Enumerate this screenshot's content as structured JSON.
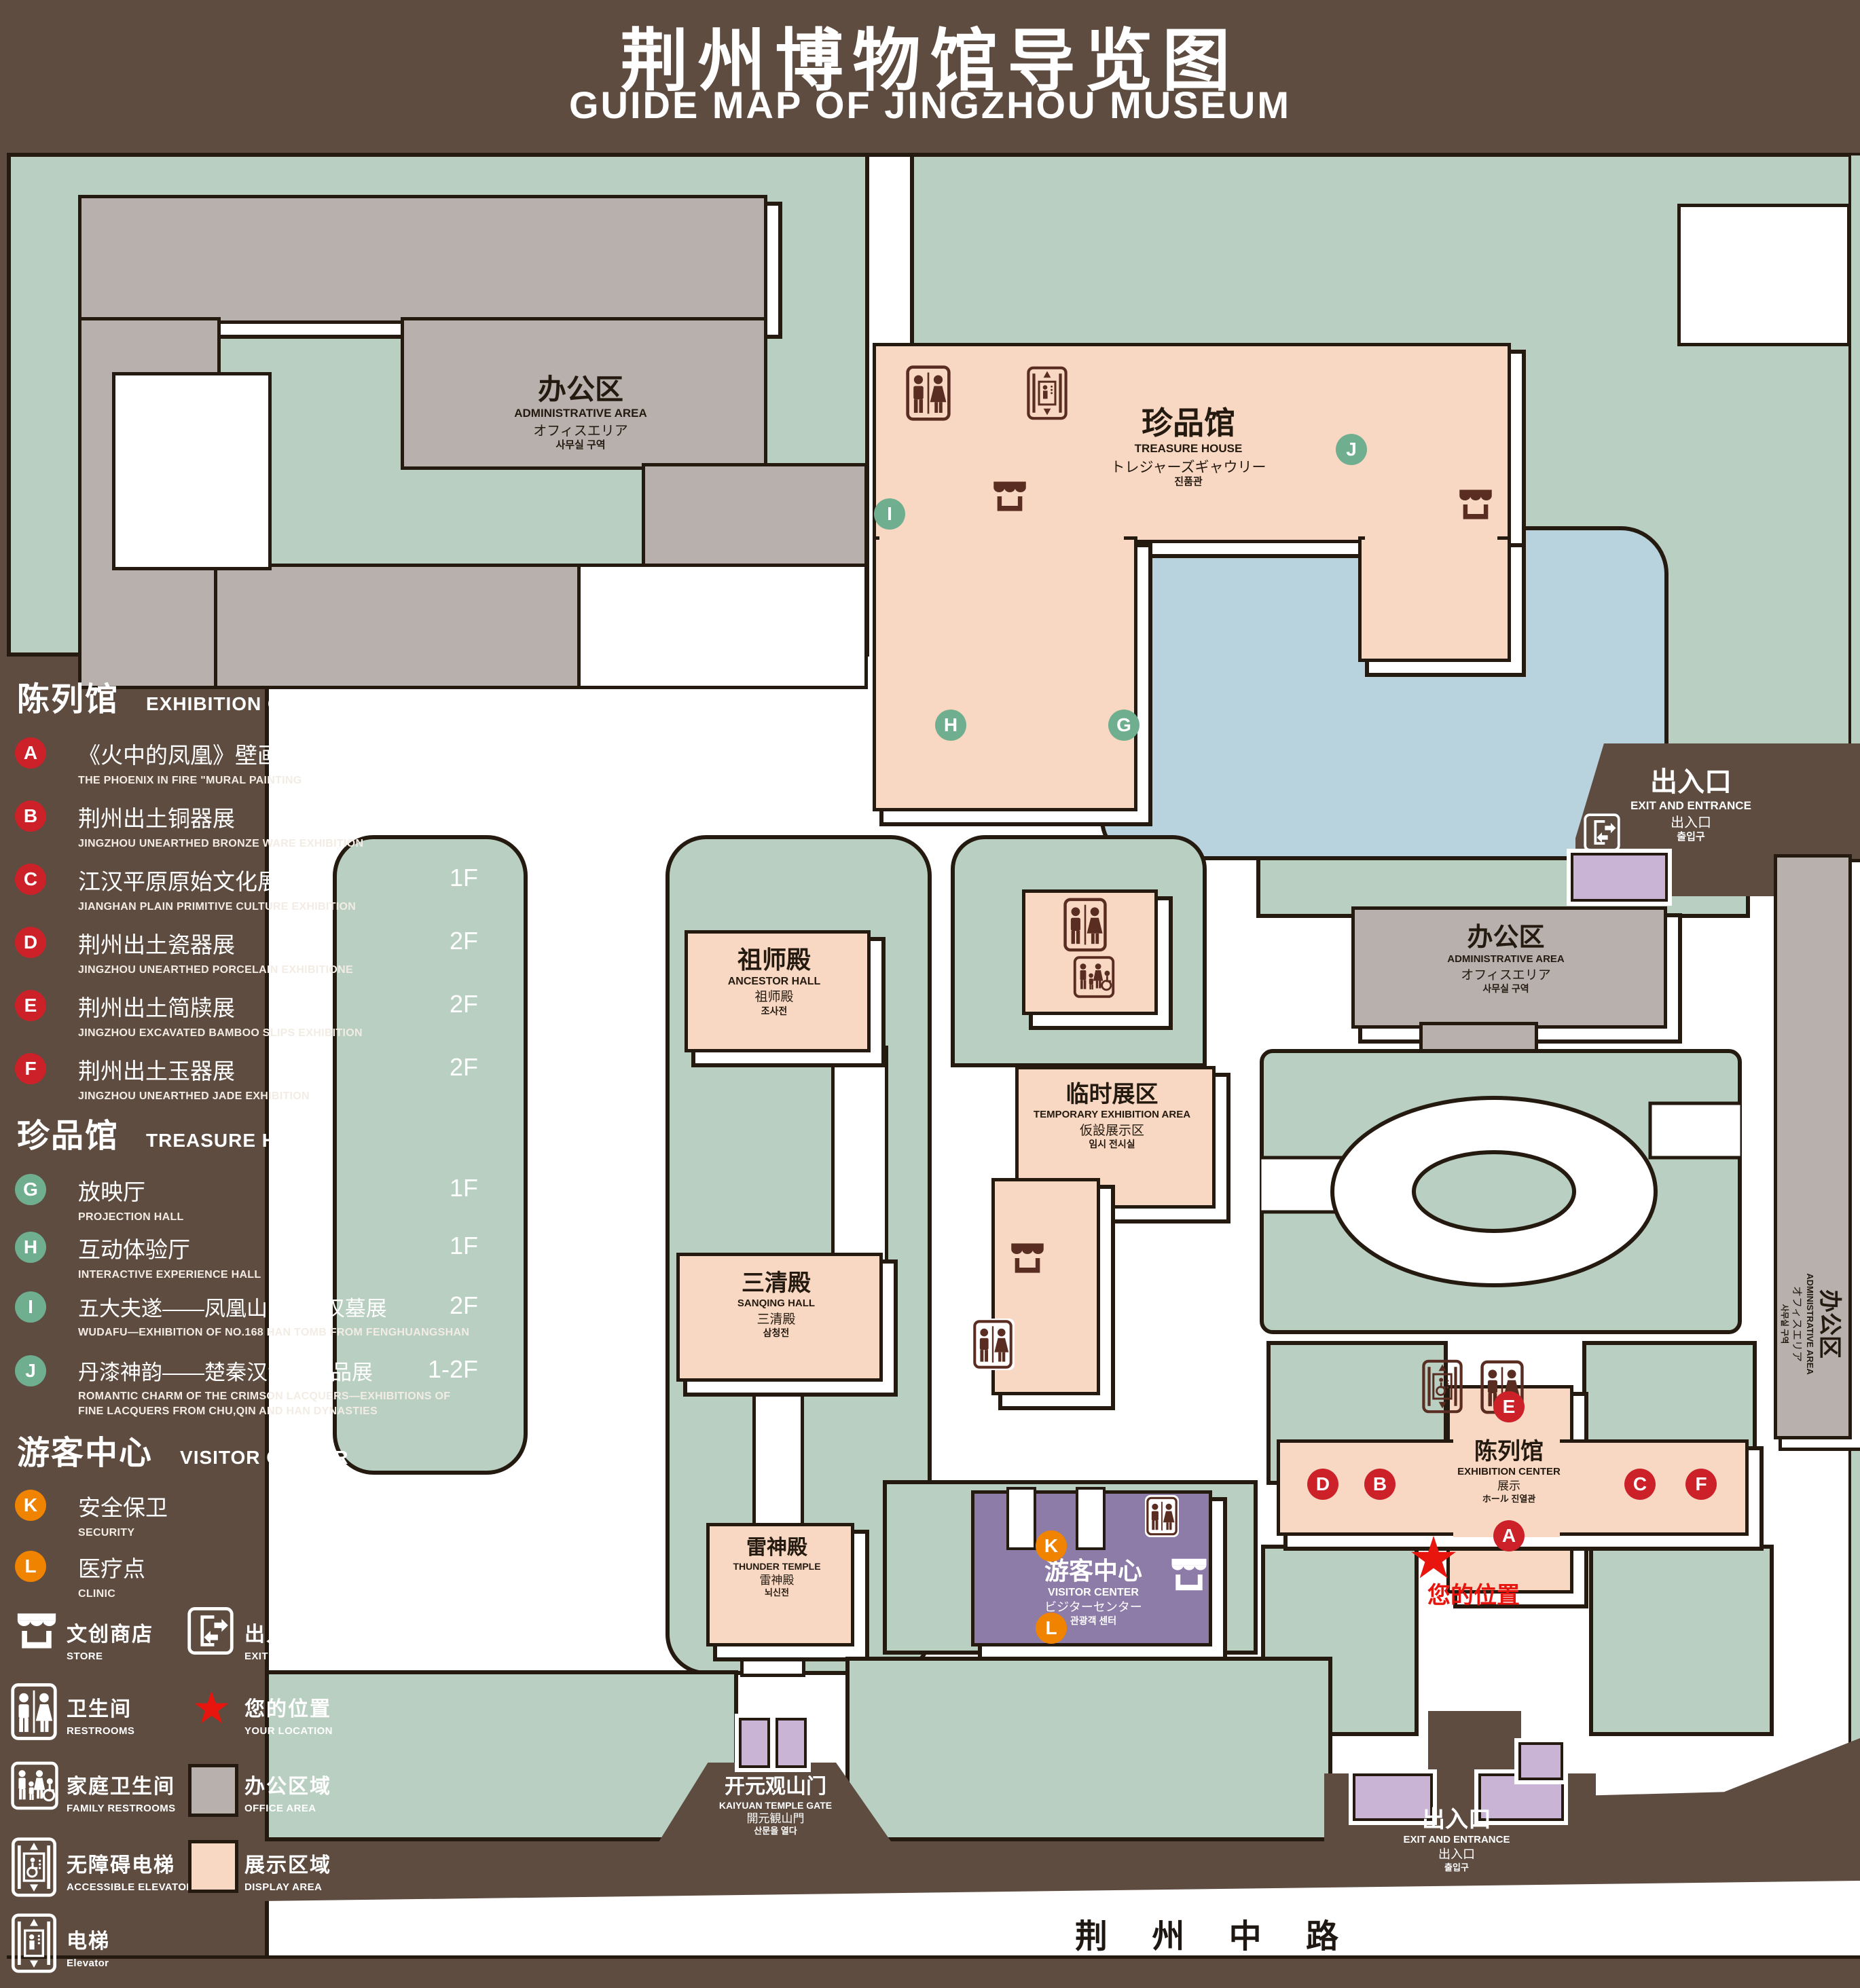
{
  "title": {
    "zh": "荆州博物馆导览图",
    "en": "GUIDE MAP OF JINGZHOU MUSEUM"
  },
  "colors": {
    "background_brown": "#5e4c40",
    "outline": "#241a10",
    "green_area": "#b8cfc2",
    "display_area_peach": "#f8d8c3",
    "office_area_gray": "#b7b0ad",
    "visitor_center_purple": "#8d7ba8",
    "small_building_lavender": "#c9b4d6",
    "pond_blue": "#b9d3de",
    "icon_maroon": "#5a2d23",
    "marker_red": "#cc2128",
    "marker_green": "#6fae8f",
    "marker_orange": "#f08300",
    "location_red": "#e8140e"
  },
  "legend": {
    "sections": [
      {
        "zh": "陈列馆",
        "en": "EXHIBITION CENTER",
        "items": [
          {
            "letter": "A",
            "title": "《火中的凤凰》壁画",
            "subtitle": "THE PHOENIX IN FIRE \"MURAL PAINTING",
            "floor": "1F"
          },
          {
            "letter": "B",
            "title": "荆州出土铜器展",
            "subtitle": "JINGZHOU UNEARTHED BRONZE WARE EXHIBITION",
            "floor": "1F"
          },
          {
            "letter": "C",
            "title": "江汉平原原始文化展",
            "subtitle": "JIANGHAN PLAIN PRIMITIVE CULTURE EXHIBITION",
            "floor": "1F"
          },
          {
            "letter": "D",
            "title": "荆州出土瓷器展",
            "subtitle": "JINGZHOU UNEARTHED PORCELAIN EXHIBITIONE",
            "floor": "2F"
          },
          {
            "letter": "E",
            "title": "荆州出土简牍展",
            "subtitle": "JINGZHOU EXCAVATED BAMBOO SLIPS EXHIBITION",
            "floor": "2F"
          },
          {
            "letter": "F",
            "title": "荆州出土玉器展",
            "subtitle": "JINGZHOU UNEARTHED JADE EXHIBITION",
            "floor": "2F"
          }
        ]
      },
      {
        "zh": "珍品馆",
        "en": "TREASURE HOUSE",
        "items": [
          {
            "letter": "G",
            "title": "放映厅",
            "subtitle": "PROJECTION HALL",
            "floor": "1F"
          },
          {
            "letter": "H",
            "title": "互动体验厅",
            "subtitle": "INTERACTIVE EXPERIENCE HALL",
            "floor": "1F"
          },
          {
            "letter": "I",
            "title": "五大夫遂——凤凰山168号汉墓展",
            "subtitle": "WUDAFU—EXHIBITION OF NO.168 HAN TOMB FROM FENGHUANGSHAN",
            "floor": "2F"
          },
          {
            "letter": "J",
            "title": "丹漆神韵——楚秦汉漆器精品展",
            "subtitle": "ROMANTIC CHARM OF THE CRIMSON LACQUERS—EXHIBITIONS OF FINE LACQUERS FROM CHU,QIN AND HAN DYNASTIES",
            "floor": "1-2F"
          }
        ]
      },
      {
        "zh": "游客中心",
        "en": "VISITOR CENTER",
        "items": [
          {
            "letter": "K",
            "title": "安全保卫",
            "subtitle": "SECURITY",
            "floor": "1F"
          },
          {
            "letter": "L",
            "title": "医疗点",
            "subtitle": "CLINIC",
            "floor": "1F"
          }
        ]
      }
    ],
    "symbols": {
      "store": {
        "zh": "文创商店",
        "en": "STORE"
      },
      "exit": {
        "zh": "出入口",
        "en": "EXIT AND ENTRANCE"
      },
      "restrooms": {
        "zh": "卫生间",
        "en": "RESTROOMS"
      },
      "location": {
        "zh": "您的位置",
        "en": "YOUR LOCATION"
      },
      "family": {
        "zh": "家庭卫生间",
        "en": "FAMILY RESTROOMS"
      },
      "office": {
        "zh": "办公区域",
        "en": "OFFICE AREA"
      },
      "accessible_elevator": {
        "zh": "无障碍电梯",
        "en": "ACCESSIBLE ELEVATOR"
      },
      "display": {
        "zh": "展示区域",
        "en": "DISPLAY AREA"
      },
      "elevator": {
        "zh": "电梯",
        "en": "Elevator"
      }
    }
  },
  "map": {
    "admin": {
      "zh": "办公区",
      "en": "ADMINISTRATIVE AREA",
      "ja": "オフィスエリア",
      "ko": "사무실 구역"
    },
    "treasure": {
      "zh": "珍品馆",
      "en": "TREASURE HOUSE",
      "ja": "トレジャーズギャウリー",
      "ko": "진품관"
    },
    "ancestor": {
      "zh": "祖师殿",
      "en": "ANCESTOR HALL",
      "ja": "祖师殿",
      "ko": "조사전"
    },
    "temp": {
      "zh": "临时展区",
      "en": "TEMPORARY EXHIBITION AREA",
      "ja": "仮設展示区",
      "ko": "임시 전시실"
    },
    "sanqing": {
      "zh": "三清殿",
      "en": "SANQING HALL",
      "ja": "三清殿",
      "ko": "삼청전"
    },
    "thunder": {
      "zh": "雷神殿",
      "en": "THUNDER TEMPLE",
      "ja": "雷神殿",
      "ko": "뇌신전"
    },
    "visitor": {
      "zh": "游客中心",
      "en": "VISITOR CENTER",
      "ja": "ビジターセンター",
      "ko": "관광객 센터"
    },
    "exhibition": {
      "zh": "陈列馆",
      "en": "EXHIBITION CENTER",
      "ja": "展示",
      "ko": "ホール 진열관"
    },
    "gate": {
      "zh": "开元观山门",
      "en": "KAIYUAN TEMPLE GATE",
      "ja": "開元観山門",
      "ko": "산문을 열다"
    },
    "exit": {
      "zh": "出入口",
      "en": "EXIT AND ENTRANCE",
      "ja": "出入口",
      "ko": "출입구"
    },
    "your_location": "您的位置",
    "road": "荆 州 中 路",
    "markers": [
      {
        "letter": "A"
      },
      {
        "letter": "B"
      },
      {
        "letter": "C"
      },
      {
        "letter": "D"
      },
      {
        "letter": "E"
      },
      {
        "letter": "F"
      },
      {
        "letter": "G"
      },
      {
        "letter": "H"
      },
      {
        "letter": "I"
      },
      {
        "letter": "J"
      },
      {
        "letter": "K"
      },
      {
        "letter": "L"
      }
    ]
  }
}
